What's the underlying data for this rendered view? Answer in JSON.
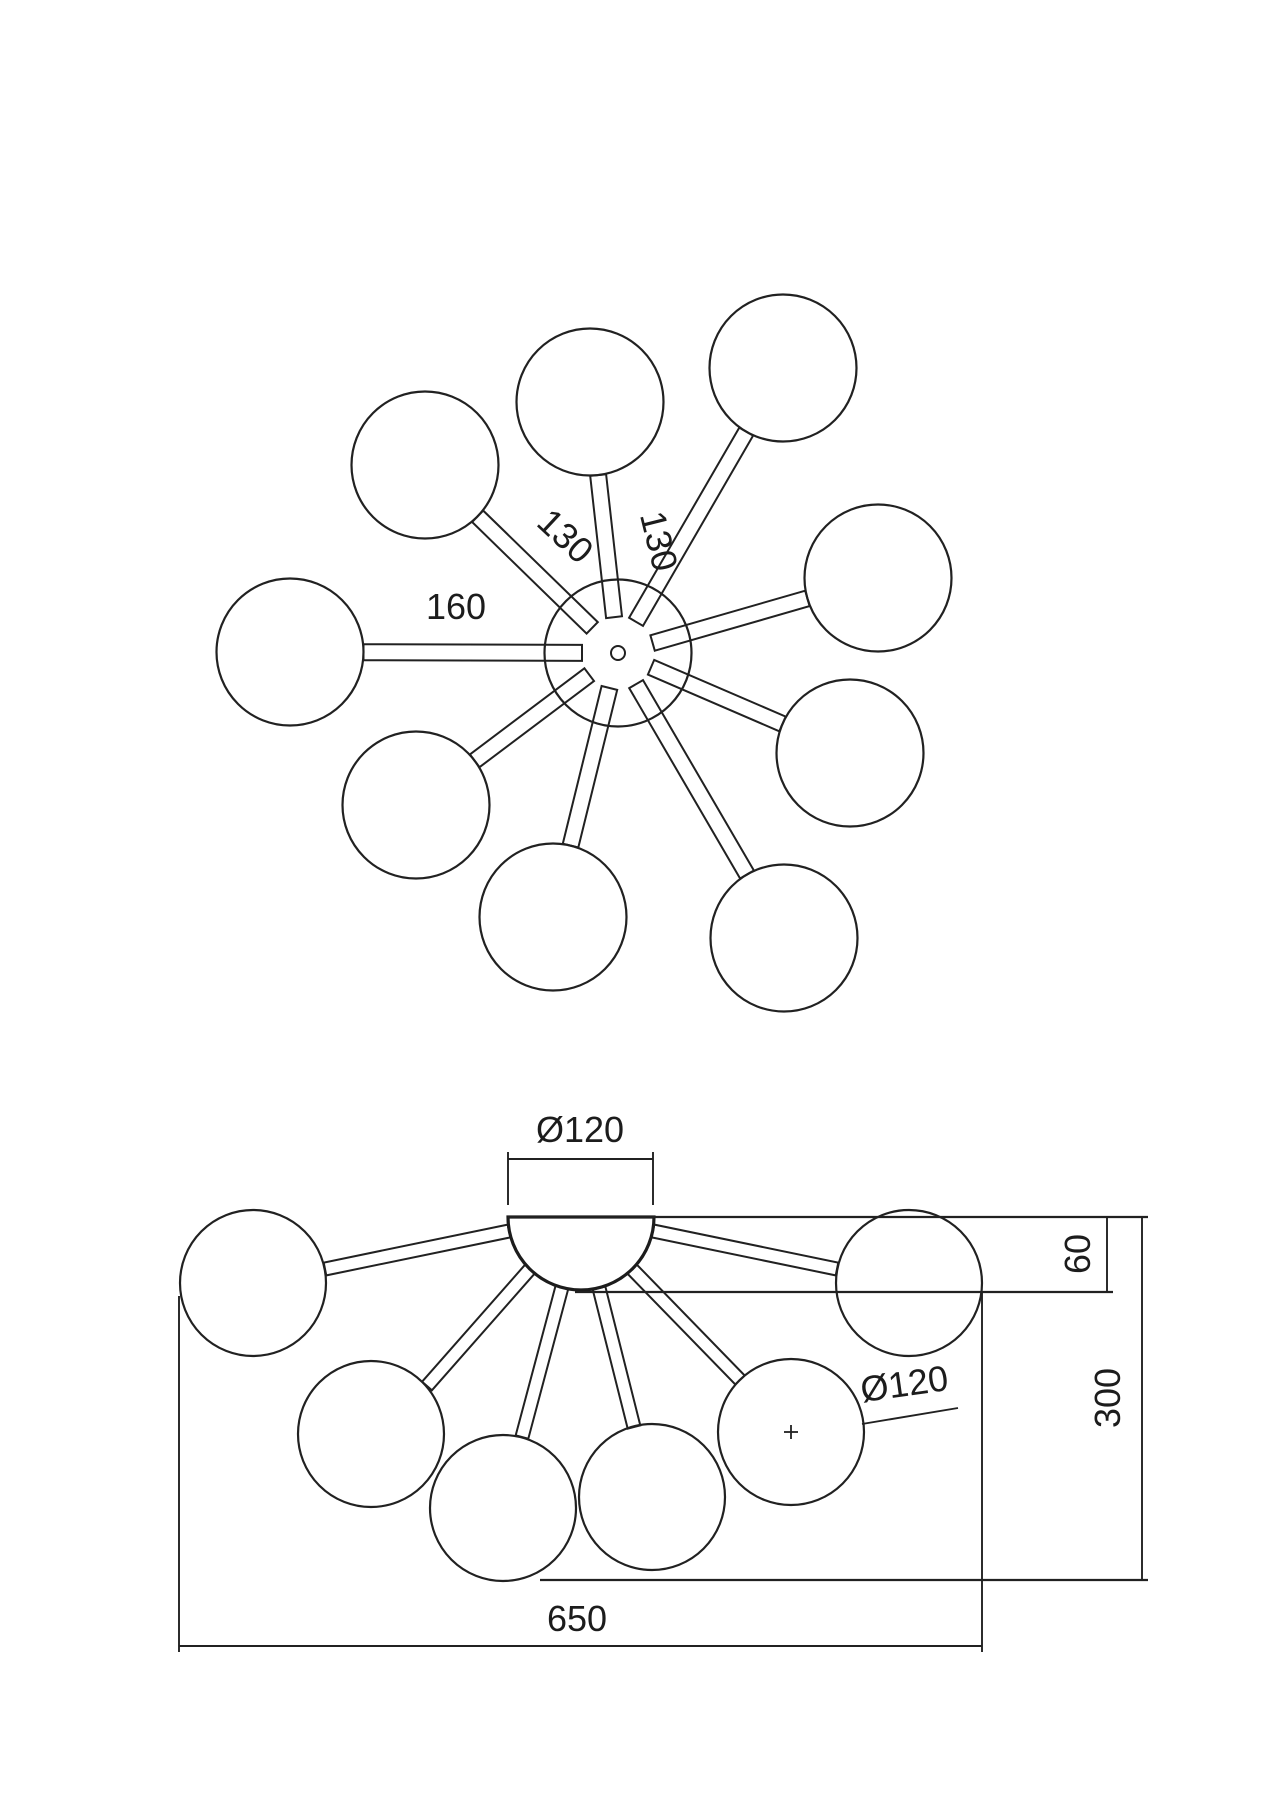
{
  "colors": {
    "background": "#ffffff",
    "line": "#212121",
    "text": "#1c1c1c"
  },
  "drawing": {
    "canvas": {
      "width": 1272,
      "height": 1800
    },
    "top_view": {
      "hub": {
        "cx": 618,
        "cy": 653,
        "r": 73.5,
        "hole_r": 7
      },
      "globe_r": 73.5,
      "arm": {
        "width": 16,
        "inner_r": 36
      },
      "globes": [
        {
          "cx": 290,
          "cy": 652
        },
        {
          "cx": 425,
          "cy": 465
        },
        {
          "cx": 590,
          "cy": 402
        },
        {
          "cx": 783,
          "cy": 368
        },
        {
          "cx": 878,
          "cy": 578
        },
        {
          "cx": 850,
          "cy": 753
        },
        {
          "cx": 784,
          "cy": 938
        },
        {
          "cx": 553,
          "cy": 917
        },
        {
          "cx": 416,
          "cy": 805
        }
      ],
      "labels": [
        {
          "text": "160",
          "x": 456,
          "y": 619,
          "rotate": 0
        },
        {
          "text": "130",
          "x": 557,
          "y": 545,
          "rotate": 43
        },
        {
          "text": "130",
          "x": 647,
          "y": 544,
          "rotate": 76
        }
      ]
    },
    "side_view": {
      "dome": {
        "cx": 581,
        "cy": 1217,
        "r": 73
      },
      "globe_r": 73,
      "arm_width": 13,
      "globes": [
        {
          "cx": 253,
          "cy": 1283
        },
        {
          "cx": 909,
          "cy": 1283
        },
        {
          "cx": 371,
          "cy": 1434
        },
        {
          "cx": 503,
          "cy": 1508
        },
        {
          "cx": 652,
          "cy": 1497
        },
        {
          "cx": 791,
          "cy": 1432,
          "center_mark": true
        }
      ],
      "arms": [
        [
          509,
          1231,
          325,
          1269
        ],
        [
          653,
          1231,
          837,
          1269
        ],
        [
          530,
          1269,
          427,
          1386
        ],
        [
          562,
          1287,
          522,
          1437
        ],
        [
          599,
          1288,
          634,
          1427
        ],
        [
          632,
          1269,
          740,
          1380
        ]
      ],
      "outline_lines": [
        [
          508,
          1217,
          1148,
          1217
        ],
        [
          575,
          1292,
          1113,
          1292
        ],
        [
          540,
          1580,
          1148,
          1580
        ]
      ],
      "dim_lines": [
        [
          508,
          1152,
          508,
          1205
        ],
        [
          653,
          1152,
          653,
          1205
        ],
        [
          508,
          1159,
          653,
          1159
        ],
        [
          1107,
          1217,
          1107,
          1292
        ],
        [
          1142,
          1217,
          1142,
          1580
        ],
        [
          179,
          1296,
          179,
          1652
        ],
        [
          982,
          1292,
          982,
          1652
        ],
        [
          179,
          1646,
          982,
          1646
        ],
        [
          862,
          1424,
          958,
          1408
        ]
      ],
      "labels": [
        {
          "text": "Ø120",
          "x": 580,
          "y": 1142,
          "rotate": 0
        },
        {
          "text": "60",
          "x": 1090,
          "y": 1254,
          "rotate": -90
        },
        {
          "text": "300",
          "x": 1120,
          "y": 1398,
          "rotate": -90
        },
        {
          "text": "650",
          "x": 577,
          "y": 1631,
          "rotate": 0
        },
        {
          "text": "Ø120",
          "x": 906,
          "y": 1396,
          "rotate": -8
        }
      ]
    }
  }
}
